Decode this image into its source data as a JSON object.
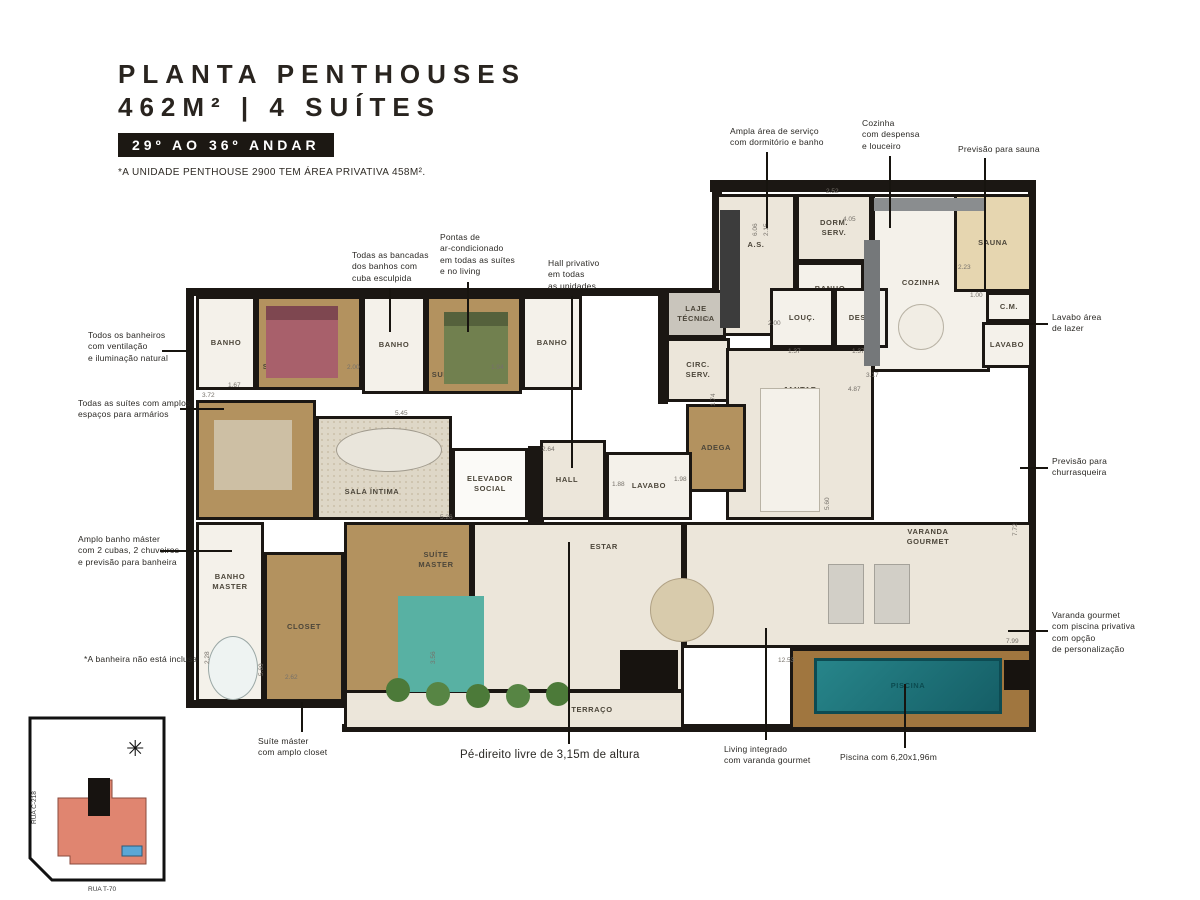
{
  "header": {
    "title_line1": "PLANTA PENTHOUSES",
    "title_line2": "462M² | 4 SUÍTES",
    "badge": "29º AO 36º ANDAR",
    "footnote": "*A UNIDADE PENTHOUSE 2900 TEM ÁREA PRIVATIVA 458M²."
  },
  "icons": {
    "compass": "✳"
  },
  "keyplan": {
    "street_left": "RUA C-218",
    "street_bottom": "RUA T-70"
  },
  "palette": {
    "cream": "#ece6da",
    "tile": "#f4f1ea",
    "wood": "#b3925f",
    "deck": "#a0763f",
    "gray": "#c9c5bc",
    "white": "#fbfaf7",
    "sand": "#e6d6b0",
    "rug": "radial-gradient(#cabfa8 1px, rgba(0,0,0,0) 1px) 0 0/6px 6px #ded7c7",
    "pool": "linear-gradient(135deg,#27858a,#155e66)",
    "wall": "#1b1713",
    "accent_building": "#e08570",
    "accent_pool": "#5aa7d6"
  },
  "plan": {
    "walls": [
      {
        "x": 710,
        "y": 180,
        "w": 326,
        "h": 12
      },
      {
        "x": 186,
        "y": 288,
        "w": 530,
        "h": 8
      },
      {
        "x": 186,
        "y": 288,
        "w": 8,
        "h": 420
      },
      {
        "x": 1028,
        "y": 186,
        "w": 8,
        "h": 546
      },
      {
        "x": 186,
        "y": 700,
        "w": 164,
        "h": 8
      },
      {
        "x": 342,
        "y": 724,
        "w": 694,
        "h": 8
      },
      {
        "x": 528,
        "y": 446,
        "w": 16,
        "h": 76
      },
      {
        "x": 712,
        "y": 180,
        "w": 10,
        "h": 118
      },
      {
        "x": 658,
        "y": 288,
        "w": 10,
        "h": 116
      }
    ],
    "rooms": [
      {
        "id": "as",
        "label": "A.S.",
        "x": 716,
        "y": 194,
        "w": 80,
        "h": 142,
        "fill": "cream",
        "dy": -20
      },
      {
        "id": "dorm-serv",
        "label": "DORM.\nSERV.",
        "x": 796,
        "y": 194,
        "w": 76,
        "h": 68,
        "fill": "cream"
      },
      {
        "id": "banho-serv",
        "label": "BANHO",
        "x": 796,
        "y": 262,
        "w": 68,
        "h": 54,
        "fill": "tile"
      },
      {
        "id": "cozinha",
        "label": "COZINHA",
        "x": 872,
        "y": 194,
        "w": 118,
        "h": 178,
        "fill": "tile",
        "dx": -10
      },
      {
        "id": "sauna",
        "label": "SAUNA",
        "x": 954,
        "y": 194,
        "w": 78,
        "h": 98,
        "fill": "sand"
      },
      {
        "id": "cm",
        "label": "C.M.",
        "x": 986,
        "y": 292,
        "w": 46,
        "h": 30,
        "fill": "tile"
      },
      {
        "id": "lavabo-lazer",
        "label": "LAVABO",
        "x": 982,
        "y": 322,
        "w": 50,
        "h": 46,
        "fill": "tile"
      },
      {
        "id": "laje-tecnica",
        "label": "LAJE\nTÉCNICA",
        "x": 666,
        "y": 290,
        "w": 60,
        "h": 48,
        "fill": "gray"
      },
      {
        "id": "circ-serv",
        "label": "CIRC.\nSERV.",
        "x": 666,
        "y": 338,
        "w": 64,
        "h": 64,
        "fill": "cream"
      },
      {
        "id": "louc",
        "label": "LOUÇ.",
        "x": 770,
        "y": 288,
        "w": 64,
        "h": 60,
        "fill": "tile"
      },
      {
        "id": "desp",
        "label": "DESP.",
        "x": 834,
        "y": 288,
        "w": 54,
        "h": 60,
        "fill": "tile"
      },
      {
        "id": "jantar",
        "label": "JANTAR",
        "x": 726,
        "y": 348,
        "w": 148,
        "h": 172,
        "fill": "cream",
        "dy": -44
      },
      {
        "id": "adega",
        "label": "ADEGA",
        "x": 686,
        "y": 404,
        "w": 60,
        "h": 88,
        "fill": "wood"
      },
      {
        "id": "hall",
        "label": "HALL",
        "x": 540,
        "y": 440,
        "w": 66,
        "h": 80,
        "fill": "cream",
        "dx": -6
      },
      {
        "id": "lavabo",
        "label": "LAVABO",
        "x": 606,
        "y": 452,
        "w": 86,
        "h": 68,
        "fill": "tile"
      },
      {
        "id": "elevador-social",
        "label": "ELEVADOR\nSOCIAL",
        "x": 452,
        "y": 448,
        "w": 76,
        "h": 72,
        "fill": "white"
      },
      {
        "id": "sala-intima",
        "label": "SALA ÍNTIMA",
        "x": 316,
        "y": 416,
        "w": 136,
        "h": 104,
        "fill": "rug",
        "dx": -12,
        "dy": 24
      },
      {
        "id": "suite-1",
        "label": "SUÍTE 1",
        "x": 196,
        "y": 400,
        "w": 120,
        "h": 120,
        "fill": "wood",
        "dx": -26,
        "dy": -18
      },
      {
        "id": "banho-suite-1",
        "label": "BANHO",
        "x": 196,
        "y": 296,
        "w": 60,
        "h": 94,
        "fill": "tile"
      },
      {
        "id": "suite-2",
        "label": "SUÍTE 2",
        "x": 256,
        "y": 296,
        "w": 106,
        "h": 94,
        "fill": "wood",
        "dx": -30,
        "dy": 24
      },
      {
        "id": "banho-suite-2",
        "label": "BANHO",
        "x": 362,
        "y": 296,
        "w": 64,
        "h": 98,
        "fill": "tile"
      },
      {
        "id": "suite-3",
        "label": "SUÍTE 3",
        "x": 426,
        "y": 296,
        "w": 96,
        "h": 98,
        "fill": "wood",
        "dx": -26,
        "dy": 30
      },
      {
        "id": "banho-suite-3",
        "label": "BANHO",
        "x": 522,
        "y": 296,
        "w": 60,
        "h": 94,
        "fill": "tile"
      },
      {
        "id": "banho-master",
        "label": "BANHO\nMASTER",
        "x": 196,
        "y": 522,
        "w": 68,
        "h": 180,
        "fill": "tile",
        "dy": -30
      },
      {
        "id": "closet",
        "label": "CLOSET",
        "x": 264,
        "y": 552,
        "w": 80,
        "h": 150,
        "fill": "wood"
      },
      {
        "id": "suite-master",
        "label": "SUÍTE\nMASTER",
        "x": 344,
        "y": 522,
        "w": 128,
        "h": 180,
        "fill": "wood",
        "dx": 28,
        "dy": -52
      },
      {
        "id": "estar",
        "label": "ESTAR",
        "x": 472,
        "y": 522,
        "w": 212,
        "h": 170,
        "fill": "cream",
        "dx": 26,
        "dy": -60
      },
      {
        "id": "terraco",
        "label": "TERRAÇO",
        "x": 344,
        "y": 690,
        "w": 340,
        "h": 40,
        "fill": "cream",
        "dx": 78
      },
      {
        "id": "varanda-gourmet",
        "label": "VARANDA\nGOURMET",
        "x": 684,
        "y": 522,
        "w": 348,
        "h": 126,
        "fill": "cream",
        "dx": 70,
        "dy": -48
      },
      {
        "id": "deck-piscina",
        "label": "",
        "x": 790,
        "y": 648,
        "w": 242,
        "h": 82,
        "fill": "deck"
      },
      {
        "id": "piscina",
        "label": "PISCINA",
        "x": 814,
        "y": 658,
        "w": 188,
        "h": 56,
        "fill": "pool",
        "bc": "#0d4b52",
        "lc": "#0b4b50"
      }
    ],
    "furniture": [
      {
        "id": "bed-suite-2",
        "x": 266,
        "y": 306,
        "w": 72,
        "h": 72,
        "c": "#a8606b"
      },
      {
        "id": "headboard-suite-2",
        "x": 266,
        "y": 306,
        "w": 72,
        "h": 14,
        "c": "#7e4750"
      },
      {
        "id": "bed-suite-3",
        "x": 444,
        "y": 312,
        "w": 64,
        "h": 72,
        "c": "#71804f"
      },
      {
        "id": "headboard-suite-3",
        "x": 444,
        "y": 312,
        "w": 64,
        "h": 14,
        "c": "#55613c"
      },
      {
        "id": "bed-suite-1",
        "x": 214,
        "y": 420,
        "w": 78,
        "h": 70,
        "c": "#cdbfa4"
      },
      {
        "id": "bed-master",
        "x": 398,
        "y": 596,
        "w": 86,
        "h": 96,
        "c": "#58b1a3"
      },
      {
        "id": "sofa-sala-intima",
        "x": 336,
        "y": 428,
        "w": 106,
        "h": 44,
        "c": "#e9e5db",
        "shape": "ellipse",
        "b": "#a09a8d"
      },
      {
        "id": "dining-table",
        "x": 760,
        "y": 388,
        "w": 60,
        "h": 124,
        "c": "#f4f1ea",
        "b": "#b9b3a5"
      },
      {
        "id": "estar-table",
        "x": 650,
        "y": 578,
        "w": 64,
        "h": 64,
        "c": "#d8cbac",
        "shape": "ellipse",
        "b": "#b0a184"
      },
      {
        "id": "bathtub",
        "x": 208,
        "y": 636,
        "w": 50,
        "h": 64,
        "c": "#eef3f2",
        "shape": "ellipse",
        "b": "#9aa7a5"
      },
      {
        "id": "kitchen-table",
        "x": 898,
        "y": 304,
        "w": 46,
        "h": 46,
        "c": "#f1ede4",
        "shape": "ellipse",
        "b": "#b9b3a5"
      },
      {
        "id": "kitchen-counter",
        "x": 864,
        "y": 240,
        "w": 16,
        "h": 126,
        "c": "#75787a"
      },
      {
        "id": "kitchen-counter-top",
        "x": 874,
        "y": 198,
        "w": 112,
        "h": 13,
        "c": "#8a8d8f"
      },
      {
        "id": "as-cabinet",
        "x": 720,
        "y": 210,
        "w": 20,
        "h": 118,
        "c": "#3c3c3c"
      },
      {
        "id": "plant-1",
        "x": 386,
        "y": 678,
        "w": 24,
        "h": 24,
        "c": "#4c7a39",
        "shape": "ellipse"
      },
      {
        "id": "plant-2",
        "x": 426,
        "y": 682,
        "w": 24,
        "h": 24,
        "c": "#578544",
        "shape": "ellipse"
      },
      {
        "id": "plant-3",
        "x": 466,
        "y": 684,
        "w": 24,
        "h": 24,
        "c": "#4c7a39",
        "shape": "ellipse"
      },
      {
        "id": "plant-4",
        "x": 506,
        "y": 684,
        "w": 24,
        "h": 24,
        "c": "#578544",
        "shape": "ellipse"
      },
      {
        "id": "plant-5",
        "x": 546,
        "y": 682,
        "w": 24,
        "h": 24,
        "c": "#4c7a39",
        "shape": "ellipse"
      },
      {
        "id": "planter-box",
        "x": 620,
        "y": 650,
        "w": 58,
        "h": 40,
        "c": "#17130f"
      },
      {
        "id": "lounger-1",
        "x": 828,
        "y": 564,
        "w": 36,
        "h": 60,
        "c": "#d2cfc7",
        "b": "#a5a29a"
      },
      {
        "id": "lounger-2",
        "x": 874,
        "y": 564,
        "w": 36,
        "h": 60,
        "c": "#d2cfc7",
        "b": "#a5a29a"
      },
      {
        "id": "pool-bench",
        "x": 1004,
        "y": 660,
        "w": 26,
        "h": 30,
        "c": "#17130f"
      }
    ],
    "dimensions": [
      {
        "t": "2.52",
        "x": 826,
        "y": 188
      },
      {
        "t": "6.06",
        "x": 752,
        "y": 236,
        "r": 1
      },
      {
        "t": "2.15",
        "x": 763,
        "y": 236,
        "r": 1
      },
      {
        "t": "4.05",
        "x": 843,
        "y": 216
      },
      {
        "t": "2.23",
        "x": 958,
        "y": 264
      },
      {
        "t": "1.00",
        "x": 970,
        "y": 292
      },
      {
        "t": "2.00",
        "x": 768,
        "y": 320
      },
      {
        "t": "1.37",
        "x": 788,
        "y": 348
      },
      {
        "t": "1.37",
        "x": 852,
        "y": 348
      },
      {
        "t": "1.62",
        "x": 697,
        "y": 316
      },
      {
        "t": "1.74",
        "x": 710,
        "y": 406,
        "r": 1
      },
      {
        "t": "4.87",
        "x": 848,
        "y": 386
      },
      {
        "t": "3.17",
        "x": 866,
        "y": 372
      },
      {
        "t": "1.98",
        "x": 674,
        "y": 476
      },
      {
        "t": "5.26",
        "x": 440,
        "y": 514
      },
      {
        "t": "2.64",
        "x": 542,
        "y": 446
      },
      {
        "t": "1.88",
        "x": 612,
        "y": 481
      },
      {
        "t": "1.67",
        "x": 228,
        "y": 382
      },
      {
        "t": "3.72",
        "x": 202,
        "y": 392
      },
      {
        "t": "2.00",
        "x": 347,
        "y": 364
      },
      {
        "t": "1.94",
        "x": 491,
        "y": 364
      },
      {
        "t": "5.45",
        "x": 395,
        "y": 410
      },
      {
        "t": "2.28",
        "x": 204,
        "y": 664,
        "r": 1
      },
      {
        "t": "5.60",
        "x": 258,
        "y": 676,
        "r": 1
      },
      {
        "t": "2.62",
        "x": 285,
        "y": 674
      },
      {
        "t": "3.56",
        "x": 430,
        "y": 664,
        "r": 1
      },
      {
        "t": "12.53",
        "x": 778,
        "y": 657
      },
      {
        "t": "7.99",
        "x": 1006,
        "y": 638
      },
      {
        "t": "7.72",
        "x": 1012,
        "y": 536,
        "r": 1
      },
      {
        "t": "5.60",
        "x": 824,
        "y": 510,
        "r": 1
      }
    ]
  },
  "callouts": [
    {
      "id": "area-servico",
      "text": "Ampla área de serviço\ncom dormitório e banho",
      "x": 730,
      "y": 126,
      "line": {
        "x": 766,
        "y": 152,
        "w": 2,
        "h": 76
      }
    },
    {
      "id": "cozinha-despensa",
      "text": "Cozinha\ncom despensa\ne louceiro",
      "x": 862,
      "y": 118,
      "line": {
        "x": 889,
        "y": 156,
        "w": 2,
        "h": 72
      }
    },
    {
      "id": "previsao-sauna",
      "text": "Previsão para sauna",
      "x": 958,
      "y": 144,
      "line": {
        "x": 984,
        "y": 158,
        "w": 2,
        "h": 134
      }
    },
    {
      "id": "bancadas-cuba",
      "text": "Todas as bancadas\ndos banhos com\ncuba esculpida",
      "x": 352,
      "y": 250,
      "line": {
        "x": 389,
        "y": 288,
        "w": 2,
        "h": 44
      }
    },
    {
      "id": "ar-condicionado",
      "text": "Pontas de\nar-condicionado\nem todas as suítes\ne no living",
      "x": 440,
      "y": 232,
      "line": {
        "x": 467,
        "y": 282,
        "w": 2,
        "h": 50
      }
    },
    {
      "id": "hall-privativo",
      "text": "Hall privativo\nem todas\nas unidades",
      "x": 548,
      "y": 258,
      "line": {
        "x": 571,
        "y": 296,
        "w": 2,
        "h": 172
      }
    },
    {
      "id": "banheiros-ventilacao",
      "text": "Todos os banheiros\ncom ventilação\ne iluminação natural",
      "x": 88,
      "y": 330,
      "line": {
        "x": 162,
        "y": 350,
        "w": 28,
        "h": 2
      }
    },
    {
      "id": "suites-armarios",
      "text": "Todas as suítes com amplos\nespaços para armários",
      "x": 78,
      "y": 398,
      "line": {
        "x": 180,
        "y": 408,
        "w": 44,
        "h": 2
      }
    },
    {
      "id": "banho-master-detalhes",
      "text": "Amplo banho máster\ncom 2 cubas, 2 chuveiros\ne previsão para banheira",
      "x": 78,
      "y": 534,
      "line": {
        "x": 160,
        "y": 550,
        "w": 72,
        "h": 2
      }
    },
    {
      "id": "banheira-nota",
      "text": "*A banheira não está inclusa",
      "x": 84,
      "y": 654
    },
    {
      "id": "lavabo-lazer-nota",
      "text": "Lavabo área\nde lazer",
      "x": 1052,
      "y": 312,
      "line": {
        "x": 1020,
        "y": 323,
        "w": 28,
        "h": 2
      }
    },
    {
      "id": "previsao-churrasqueira",
      "text": "Previsão para\nchurrasqueira",
      "x": 1052,
      "y": 456,
      "line": {
        "x": 1020,
        "y": 467,
        "w": 28,
        "h": 2
      }
    },
    {
      "id": "varanda-piscina-privativa",
      "text": "Varanda gourmet\ncom piscina privativa\ncom opção\nde personalização",
      "x": 1052,
      "y": 610,
      "line": {
        "x": 1008,
        "y": 630,
        "w": 40,
        "h": 2
      }
    },
    {
      "id": "suite-master-closet",
      "text": "Suíte máster\ncom amplo closet",
      "x": 258,
      "y": 736,
      "line": {
        "x": 301,
        "y": 702,
        "w": 2,
        "h": 30
      }
    },
    {
      "id": "pe-direito",
      "text": "Pé-direito livre de 3,15m de altura",
      "x": 460,
      "y": 748,
      "size": 11.5,
      "line": {
        "x": 568,
        "y": 542,
        "w": 2,
        "h": 202
      }
    },
    {
      "id": "living-integrado",
      "text": "Living integrado\ncom varanda gourmet",
      "x": 724,
      "y": 744,
      "line": {
        "x": 765,
        "y": 628,
        "w": 2,
        "h": 112
      }
    },
    {
      "id": "piscina-dimensoes",
      "text": "Piscina com 6,20x1,96m",
      "x": 840,
      "y": 752,
      "line": {
        "x": 904,
        "y": 684,
        "w": 2,
        "h": 64
      }
    }
  ]
}
